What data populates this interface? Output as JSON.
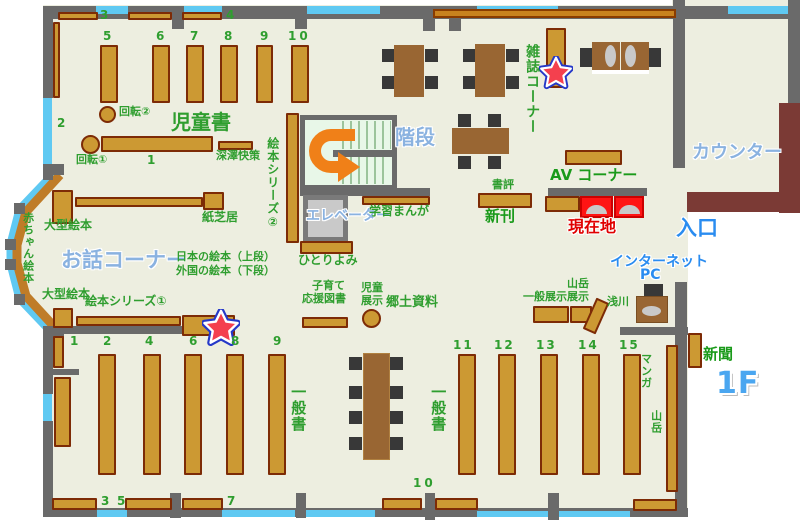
{
  "floor_label": "1F",
  "areas": {
    "jidosho": "児童書",
    "ohanashi_corner": "お話コーナー",
    "kaidan": "階段",
    "elevator": "エレベーター",
    "counter": "カウンター",
    "zasshi_corner": "雑誌コーナー",
    "av_corner": "AV コーナー",
    "iriguchi": "入口",
    "internet": "インターネット",
    "pc": "PC",
    "genzaichi": "現在地",
    "shinkan": "新刊",
    "shohyo": "書評",
    "shinbun": "新聞",
    "ippansho_left": "一般書",
    "ippansho_center": "一般書",
    "manga": "マンガ",
    "sangaku": "山岳",
    "kyodo_shiryo": "郷土資料"
  },
  "labels": {
    "kaiten1": "回転①",
    "kaiten2": "回転②",
    "fukazawa": "深澤快策",
    "kamishibai": "紙芝居",
    "ogata_ehon_upper": "大型絵本",
    "ogata_ehon_lower": "大型絵本",
    "ehon_series1": "絵本シリーズ①",
    "ehon_series2": "絵本シリーズ②",
    "akachan_ehon": "赤ちゃん絵本",
    "hitoriyomi": "ひとりよみ",
    "gakushu_manga": "学習まんが",
    "nihon_ehon": "日本の絵本（上段）",
    "gaikoku_ehon": "外国の絵本（下段）",
    "kosodate1": "子育て",
    "kosodate2": "応援図書",
    "jido_tenji1": "児童",
    "jido_tenji2": "展示",
    "ippan_tenji": "一般展示",
    "sangaku_tenji1": "山岳",
    "sangaku_tenji2": "展示",
    "asakawa": "浅川"
  },
  "numbers": {
    "top_wall": [
      "3",
      "4"
    ],
    "children_cols": [
      "5",
      "6",
      "7",
      "8",
      "9",
      "10"
    ],
    "children_left": "2",
    "children_row": "1",
    "lower_left_cols": [
      "1",
      "2",
      "4",
      "6",
      "8",
      "9"
    ],
    "bottom_wall": [
      "3",
      "5",
      "7",
      "10"
    ],
    "lower_right_cols": [
      "11",
      "12",
      "13",
      "14",
      "15"
    ]
  },
  "icons": {
    "star": "star-badge",
    "arrow": "u-turn-arrow"
  },
  "colors": {
    "floor": "#edeee0",
    "wall": "#6a6a6a",
    "window": "#5fc9f2",
    "shelf": "#cc9933",
    "shelf_border": "#7d2b06",
    "table": "#996633",
    "counter": "#7b3a35",
    "highlight_red": "#ff1414",
    "text_green": "#2f9e2f",
    "text_blue_soft": "#8ab2e0",
    "text_blue_bright": "#2a8cf0",
    "stairs": "#e8f7e8",
    "arrow_orange": "#f08018",
    "star_red": "#f4404e",
    "star_blue": "#2538c8"
  }
}
